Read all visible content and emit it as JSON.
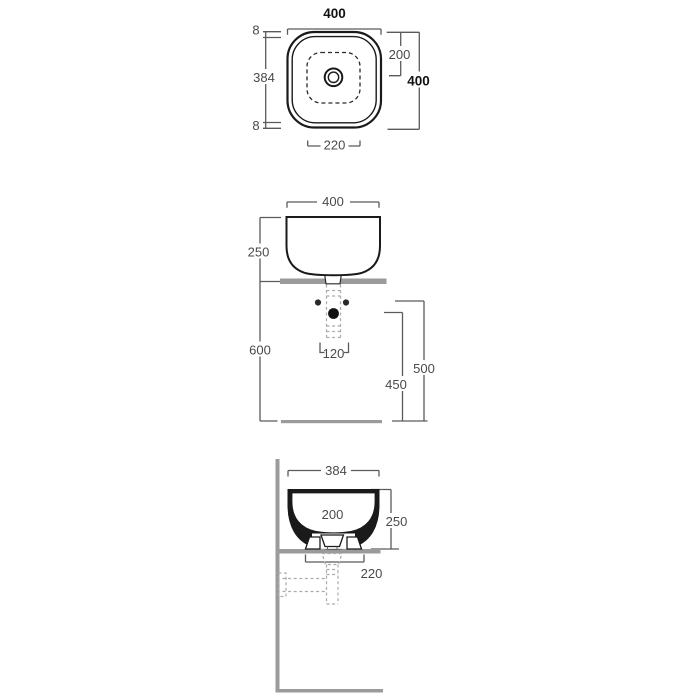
{
  "page": {
    "background": "#ffffff",
    "description": "countertop washbasin technical dimension drawing, three views"
  },
  "colors": {
    "outline": "#1a1a1a",
    "dimension_lines": "#5a5a5a",
    "dimension_text": "#4a4a4a",
    "bold_dimension_text": "#111111",
    "surface_gray": "#9b9b9b",
    "dashed_pipe_gray": "#ababab"
  },
  "views": {
    "top": {
      "name": "top view (plan)",
      "dims": {
        "overall_width": "400",
        "rim_offset_top": "8",
        "side_length": "384",
        "rim_offset_bottom": "8",
        "drain_center_from_top": "200",
        "overall_depth": "400",
        "inner_bottom_width": "220"
      }
    },
    "front": {
      "name": "front view (elevation)",
      "dims": {
        "overall_width": "400",
        "basin_height": "250",
        "counter_height": "600",
        "hole_spacing": "120",
        "drain_outlet_height": "450",
        "supply_height": "500"
      }
    },
    "side": {
      "name": "side view (section)",
      "dims": {
        "overall_width": "384",
        "inner_depth": "200",
        "basin_height": "250",
        "base_width": "220"
      }
    }
  }
}
